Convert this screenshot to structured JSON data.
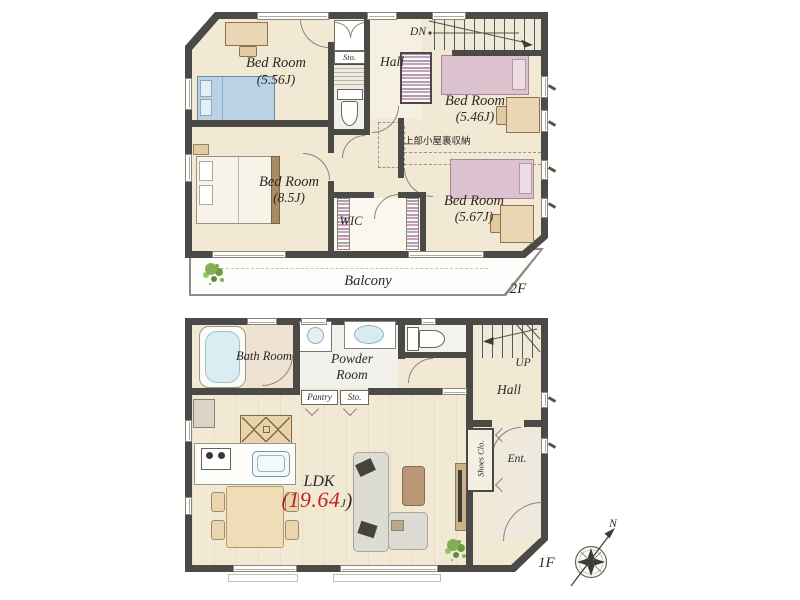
{
  "colors": {
    "wall": "#4b4a46",
    "floor_cream": "#f2e9d4",
    "accent_red": "#c32222",
    "bed_blue": "#b9d3e5",
    "bed_pink": "#dcc2cf",
    "bathtub_blue": "#d9edf2",
    "plant_green": "#83b055"
  },
  "floor2": {
    "floor_label": "2F",
    "stairs_label": "DN",
    "rooms": {
      "bedroom_a": {
        "name": "Bed Room",
        "size": "(5.56J)"
      },
      "bedroom_b": {
        "name": "Bed Room",
        "size": "(5.46J)"
      },
      "bedroom_c": {
        "name": "Bed Room",
        "size": "(8.5J)"
      },
      "bedroom_d": {
        "name": "Bed Room",
        "size": "(5.67J)"
      },
      "storage": "Sto.",
      "hall": "Hall",
      "wic": "WIC",
      "balcony": "Balcony",
      "attic_storage_note": "上部小屋裏収納"
    }
  },
  "floor1": {
    "floor_label": "1F",
    "stairs_label": "UP",
    "rooms": {
      "bath": "Bath Room",
      "powder_room_line1": "Powder",
      "powder_room_line2": "Room",
      "hall": "Hall",
      "pantry": "Pantry",
      "storage": "Sto.",
      "shoes_closet": "Shoes Clo.",
      "entrance": "Ent.",
      "ldk": {
        "name": "LDK",
        "paren_open": "(",
        "area": "19.64",
        "unit": "J",
        "paren_close": ")"
      }
    }
  },
  "compass": {
    "north_label": "N"
  }
}
